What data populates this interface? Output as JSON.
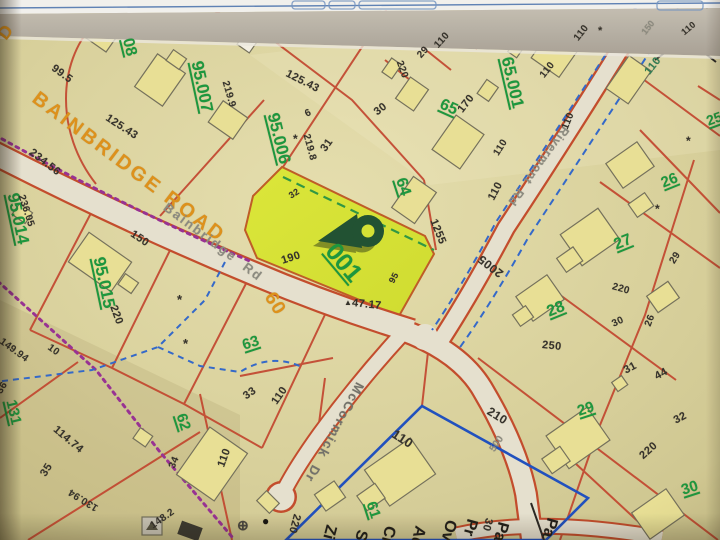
{
  "map": {
    "colors": {
      "background": "#dcd39b",
      "parcel_line": "#c8432a",
      "road_fill": "#e8e2cf",
      "road_casing": "#c94b28",
      "building_fill": "#ebe293",
      "highlight_fill": "#d9e42e",
      "parcel_number_green": "#17993a",
      "dimension_black": "#33302a",
      "road_label_orange": "#e29114",
      "street_label_gray": "#8b8a80",
      "boundary_purple": "#9c2f96",
      "water_blue": "#3069cf",
      "selection_blue": "#1d50c4",
      "pin_green": "#1e5130"
    },
    "selected_parcel": {
      "id": "001",
      "front_dim": "190",
      "corner_dim": "47.17",
      "side_dims": [
        "32",
        "95"
      ]
    },
    "labels": {
      "parcel_numbers": [
        {
          "t": "08",
          "x": 126,
          "y": 30,
          "r": 76,
          "s": 16
        },
        {
          "t": "95.007",
          "x": 196,
          "y": 52,
          "r": 78,
          "s": 17
        },
        {
          "t": "95.006",
          "x": 272,
          "y": 104,
          "r": 76,
          "s": 17
        },
        {
          "t": "64",
          "x": 399,
          "y": 170,
          "r": 72,
          "s": 16
        },
        {
          "t": "65",
          "x": 440,
          "y": 96,
          "r": 24,
          "s": 16
        },
        {
          "t": "65.001",
          "x": 506,
          "y": 48,
          "r": 77,
          "s": 17
        },
        {
          "t": "95.014",
          "x": 12,
          "y": 184,
          "r": 78,
          "s": 17
        },
        {
          "t": "95.015",
          "x": 98,
          "y": 248,
          "r": 78,
          "s": 17
        },
        {
          "t": "63",
          "x": 243,
          "y": 338,
          "r": -18,
          "s": 15
        },
        {
          "t": "62",
          "x": 180,
          "y": 406,
          "r": 72,
          "s": 15
        },
        {
          "t": "131",
          "x": 10,
          "y": 392,
          "r": 77,
          "s": 15
        },
        {
          "t": "61",
          "x": 370,
          "y": 494,
          "r": 72,
          "s": 15
        },
        {
          "t": "26",
          "x": 662,
          "y": 176,
          "r": -22,
          "s": 15
        },
        {
          "t": "27",
          "x": 615,
          "y": 238,
          "r": -22,
          "s": 16
        },
        {
          "t": "28",
          "x": 548,
          "y": 305,
          "r": -22,
          "s": 16
        },
        {
          "t": "29",
          "x": 578,
          "y": 404,
          "r": -18,
          "s": 15
        },
        {
          "t": "30",
          "x": 682,
          "y": 483,
          "r": -18,
          "s": 15
        },
        {
          "t": "25",
          "x": 707,
          "y": 114,
          "r": -20,
          "s": 14
        },
        {
          "t": "001",
          "x": 329,
          "y": 234,
          "r": 50,
          "s": 25
        }
      ],
      "dimensions": [
        {
          "t": "99.5",
          "x": 52,
          "y": 62,
          "r": 36,
          "s": 11
        },
        {
          "t": "125.43",
          "x": 106,
          "y": 112,
          "r": 33,
          "s": 11
        },
        {
          "t": "219.9",
          "x": 224,
          "y": 76,
          "r": 74,
          "s": 10
        },
        {
          "t": "234.56",
          "x": 30,
          "y": 146,
          "r": 38,
          "s": 11
        },
        {
          "t": "236.05",
          "x": 20,
          "y": 190,
          "r": 72,
          "s": 10
        },
        {
          "t": "150",
          "x": 131,
          "y": 228,
          "r": 34,
          "s": 11
        },
        {
          "t": "220",
          "x": 112,
          "y": 300,
          "r": 70,
          "s": 11
        },
        {
          "t": "149.94",
          "x": 0,
          "y": 336,
          "r": 36,
          "s": 10
        },
        {
          "t": "10",
          "x": 48,
          "y": 342,
          "r": 36,
          "s": 10
        },
        {
          "t": "125.43",
          "x": 286,
          "y": 68,
          "r": 27,
          "s": 11
        },
        {
          "t": "6",
          "x": 306,
          "y": 110,
          "r": -25,
          "s": 10
        },
        {
          "t": "219.8",
          "x": 305,
          "y": 129,
          "r": 75,
          "s": 10
        },
        {
          "t": "31",
          "x": 324,
          "y": 145,
          "r": -55,
          "s": 11
        },
        {
          "t": "30",
          "x": 376,
          "y": 108,
          "r": -38,
          "s": 11
        },
        {
          "t": "220",
          "x": 398,
          "y": 56,
          "r": 70,
          "s": 10
        },
        {
          "t": "29",
          "x": 420,
          "y": 52,
          "r": -48,
          "s": 10
        },
        {
          "t": "110",
          "x": 437,
          "y": 42,
          "r": -48,
          "s": 10
        },
        {
          "t": "170",
          "x": 461,
          "y": 106,
          "r": -52,
          "s": 11
        },
        {
          "t": "32",
          "x": 290,
          "y": 192,
          "r": -32,
          "s": 9
        },
        {
          "t": "190",
          "x": 282,
          "y": 256,
          "r": -18,
          "s": 11
        },
        {
          "t": "95",
          "x": 392,
          "y": 278,
          "r": -62,
          "s": 9
        },
        {
          "t": "47.17",
          "x": 352,
          "y": 298,
          "r": 6,
          "s": 11
        },
        {
          "t": "1255",
          "x": 432,
          "y": 214,
          "r": 68,
          "s": 11
        },
        {
          "t": "110",
          "x": 577,
          "y": 35,
          "r": -52,
          "s": 10
        },
        {
          "t": "110",
          "x": 543,
          "y": 72,
          "r": -52,
          "s": 10
        },
        {
          "t": "110",
          "x": 497,
          "y": 150,
          "r": -58,
          "s": 10
        },
        {
          "t": "110",
          "x": 566,
          "y": 124,
          "r": -68,
          "s": 10
        },
        {
          "t": "110",
          "x": 683,
          "y": 29,
          "r": -40,
          "s": 9
        },
        {
          "t": "110",
          "x": 492,
          "y": 194,
          "r": -62,
          "s": 11
        },
        {
          "t": "110",
          "x": 648,
          "y": 68,
          "r": -52,
          "s": 11,
          "c": "#2e7d52"
        },
        {
          "t": "2005",
          "x": 502,
          "y": 268,
          "r": 218,
          "s": 12
        },
        {
          "t": "220",
          "x": 612,
          "y": 282,
          "r": 16,
          "s": 10
        },
        {
          "t": "29",
          "x": 673,
          "y": 258,
          "r": -58,
          "s": 10
        },
        {
          "t": "250",
          "x": 542,
          "y": 340,
          "r": 6,
          "s": 11
        },
        {
          "t": "30",
          "x": 613,
          "y": 320,
          "r": -25,
          "s": 10
        },
        {
          "t": "26",
          "x": 649,
          "y": 321,
          "r": -70,
          "s": 10
        },
        {
          "t": "31",
          "x": 625,
          "y": 366,
          "r": -28,
          "s": 11
        },
        {
          "t": "44",
          "x": 656,
          "y": 372,
          "r": -28,
          "s": 11
        },
        {
          "t": "32",
          "x": 675,
          "y": 416,
          "r": -28,
          "s": 11
        },
        {
          "t": "220",
          "x": 642,
          "y": 452,
          "r": -42,
          "s": 11
        },
        {
          "t": "210",
          "x": 488,
          "y": 404,
          "r": 32,
          "s": 12
        },
        {
          "t": "33",
          "x": 245,
          "y": 392,
          "r": -35,
          "s": 11
        },
        {
          "t": "110",
          "x": 275,
          "y": 398,
          "r": -55,
          "s": 11
        },
        {
          "t": "110",
          "x": 393,
          "y": 426,
          "r": 33,
          "s": 13
        },
        {
          "t": "36",
          "x": 0,
          "y": 388,
          "r": -58,
          "s": 10
        },
        {
          "t": "35",
          "x": 44,
          "y": 470,
          "r": -58,
          "s": 11
        },
        {
          "t": "114.74",
          "x": 54,
          "y": 423,
          "r": 40,
          "s": 11
        },
        {
          "t": "130.94",
          "x": 98,
          "y": 502,
          "r": 212,
          "s": 10
        },
        {
          "t": "34",
          "x": 173,
          "y": 463,
          "r": -68,
          "s": 10
        },
        {
          "t": "148.2",
          "x": 152,
          "y": 522,
          "r": -35,
          "s": 10
        },
        {
          "t": "110",
          "x": 222,
          "y": 461,
          "r": -70,
          "s": 11
        },
        {
          "t": "220",
          "x": 296,
          "y": 508,
          "r": 105,
          "s": 11
        },
        {
          "t": "30",
          "x": 488,
          "y": 512,
          "r": 105,
          "s": 11
        }
      ],
      "road_names": [
        {
          "t": "BAINBRIDGE ROAD",
          "x": 34,
          "y": 86,
          "r": 37,
          "s": 20,
          "c": "#e29114",
          "ls": 3
        },
        {
          "t": "Bainbridge  Rd",
          "x": 165,
          "y": 199,
          "r": 37,
          "s": 13,
          "c": "#8b8a80",
          "ls": 2
        },
        {
          "t": "McCormick  Dr",
          "x": 360,
          "y": 376,
          "r": 118,
          "s": 13,
          "c": "#73726a",
          "ls": 1.5
        },
        {
          "t": "Rivermont  Rd",
          "x": 566,
          "y": 121,
          "r": 126,
          "s": 12,
          "c": "#8b8a80",
          "ls": 1
        },
        {
          "t": "60",
          "x": 268,
          "y": 284,
          "r": 58,
          "s": 19,
          "c": "#e29114",
          "ls": 1
        },
        {
          "t": "D",
          "x": 2,
          "y": 28,
          "r": -52,
          "s": 18,
          "c": "#e29114"
        }
      ],
      "gray_numbers": [
        {
          "t": "500",
          "x": 493,
          "y": 446,
          "r": -56,
          "s": 10
        },
        {
          "t": "150",
          "x": 644,
          "y": 29,
          "r": -52,
          "s": 9
        }
      ],
      "edge_fragments": [
        {
          "t": "Zi",
          "x": 330,
          "y": 516,
          "r": 105,
          "s": 16
        },
        {
          "t": "St",
          "x": 361,
          "y": 521,
          "r": 105,
          "s": 16
        },
        {
          "t": "Ci",
          "x": 389,
          "y": 517,
          "r": 105,
          "s": 16
        },
        {
          "t": "Ad",
          "x": 419,
          "y": 517,
          "r": 105,
          "s": 16
        },
        {
          "t": "Ov",
          "x": 450,
          "y": 511,
          "r": 105,
          "s": 16
        },
        {
          "t": "Pr",
          "x": 471,
          "y": 510,
          "r": 105,
          "s": 16
        },
        {
          "t": "Pa",
          "x": 502,
          "y": 513,
          "r": 105,
          "s": 16
        },
        {
          "t": "Pa",
          "x": 551,
          "y": 509,
          "r": 105,
          "s": 16
        }
      ],
      "symbols": [
        {
          "t": "*",
          "x": 177,
          "y": 293,
          "s": 13,
          "n": "asterisk-symbol"
        },
        {
          "t": "*",
          "x": 183,
          "y": 337,
          "s": 13,
          "n": "asterisk-symbol"
        },
        {
          "t": "*",
          "x": 293,
          "y": 133,
          "s": 12,
          "n": "asterisk-symbol"
        },
        {
          "t": "*",
          "x": 686,
          "y": 135,
          "s": 12,
          "n": "asterisk-symbol"
        },
        {
          "t": "*",
          "x": 655,
          "y": 203,
          "s": 12,
          "n": "asterisk-symbol"
        },
        {
          "t": "*",
          "x": 598,
          "y": 26,
          "s": 11,
          "n": "asterisk-symbol"
        },
        {
          "t": "▲",
          "x": 344,
          "y": 299,
          "s": 8,
          "n": "triangle-marker"
        },
        {
          "t": "⊕",
          "x": 237,
          "y": 518,
          "s": 14,
          "c": "#4a4740",
          "n": "circled-plus-symbol"
        },
        {
          "t": "●",
          "x": 262,
          "y": 515,
          "s": 12,
          "c": "#16130f",
          "n": "dot-symbol"
        }
      ]
    }
  }
}
